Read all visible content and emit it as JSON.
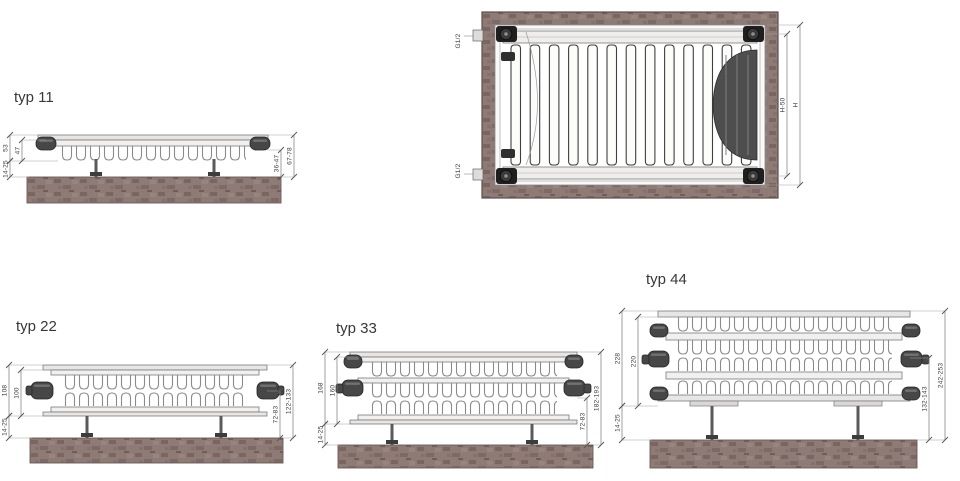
{
  "drawing": {
    "subject": "panel radiator cross sections",
    "colors": {
      "wall_brown": "#8e7b76",
      "wall_edge": "#6b5855",
      "line_gray": "#7a7a7a",
      "fin_gray": "#8a8a8a",
      "cap_dark": "#474747",
      "fitting_black": "#1f1f1f",
      "bundle_dark": "#4e4e4e",
      "dim_line": "#777777",
      "text_dark": "#3a3a3a"
    }
  },
  "front_view": {
    "connection_top": "G1/2",
    "connection_bottom": "G1/2",
    "dim_inner": "H-50",
    "dim_outer": "H"
  },
  "types": [
    {
      "id": "typ11",
      "title": "typ 11",
      "dims": {
        "depth_total": "53",
        "depth_panel": "47",
        "wall_gap": "14-25",
        "right_inner": "36-47",
        "right_outer": "67-78"
      }
    },
    {
      "id": "typ22",
      "title": "typ 22",
      "dims": {
        "depth_total": "108",
        "depth_panel": "100",
        "wall_gap": "14-25",
        "right_inner": "72-83",
        "right_outer": "122-133"
      }
    },
    {
      "id": "typ33",
      "title": "typ 33",
      "dims": {
        "depth_total": "168",
        "depth_panel": "160",
        "wall_gap": "14-25",
        "right_inner": "72-83",
        "right_outer": "182-193"
      }
    },
    {
      "id": "typ44",
      "title": "typ 44",
      "dims": {
        "depth_total": "228",
        "depth_panel": "220",
        "wall_gap": "14-25",
        "right_inner": "132-143",
        "right_outer": "242-253"
      }
    }
  ]
}
